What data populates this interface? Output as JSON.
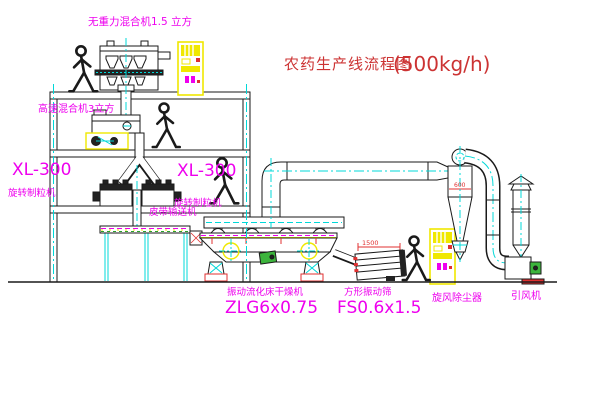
{
  "title": {
    "name": "农药生产线流程图",
    "capacity": "(500kg/h)"
  },
  "labels": {
    "gravity_mixer": "无重力混合机1.5 立方",
    "high_speed_mixer": "高速混合机3立方",
    "granulator_left_model": "XL-300",
    "granulator_left_name": "旋转制粒机",
    "granulator_right_model": "XL-300",
    "granulator_right_name": "旋转制粒机",
    "belt_conveyor": "皮带输送机",
    "dryer_name": "振动流化床干燥机",
    "dryer_model": "ZLG6x0.75",
    "sieve_name": "方形振动筛",
    "sieve_model": "FS0.6x1.5",
    "cyclone": "旋风除尘器",
    "fan": "引风机"
  },
  "dimensions": {
    "sieve_length": "1500",
    "cyclone_size": "600"
  },
  "colors": {
    "line_black": "#1a1a1a",
    "centerline_cyan": "#00d8d8",
    "label_magenta": "#ee00ee",
    "title_red": "#cc3333",
    "dimension_red": "#e03030",
    "equipment_yellow": "#f0e800",
    "motor_green": "#3cb43c",
    "background": "#ffffff"
  }
}
